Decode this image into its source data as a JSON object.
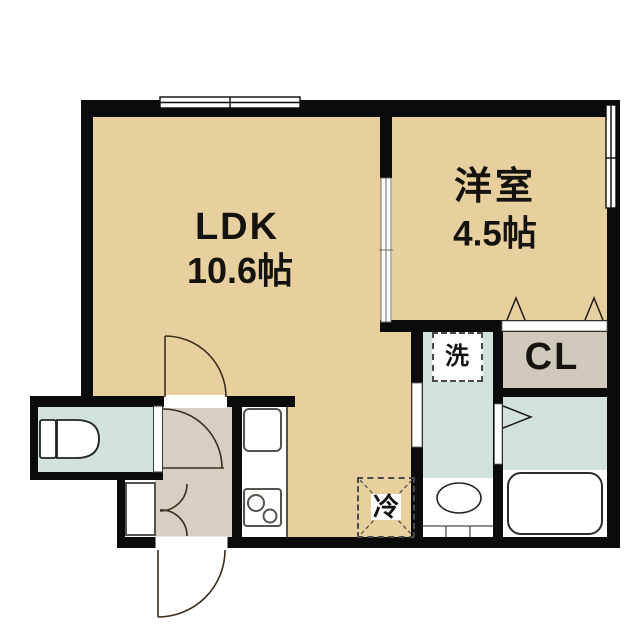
{
  "plan_title": "1LDK apartment floor plan",
  "rooms": {
    "ldk": {
      "name": "LDK",
      "size": "10.6帖"
    },
    "western_room": {
      "name": "洋室",
      "size": "4.5帖"
    },
    "closet": {
      "label": "CL"
    },
    "washer_space": {
      "label": "洗"
    },
    "fridge_space": {
      "label": "冷"
    }
  },
  "colors": {
    "wall": "#0b0b0b",
    "floor_tan": "#e8cf9e",
    "floor_gray": "#d5d0c2",
    "floor_blue": "#d2e2df",
    "closet_gray": "#d0cabc",
    "line_dark": "#3a2f1e",
    "fixture_stroke": "#333333"
  }
}
